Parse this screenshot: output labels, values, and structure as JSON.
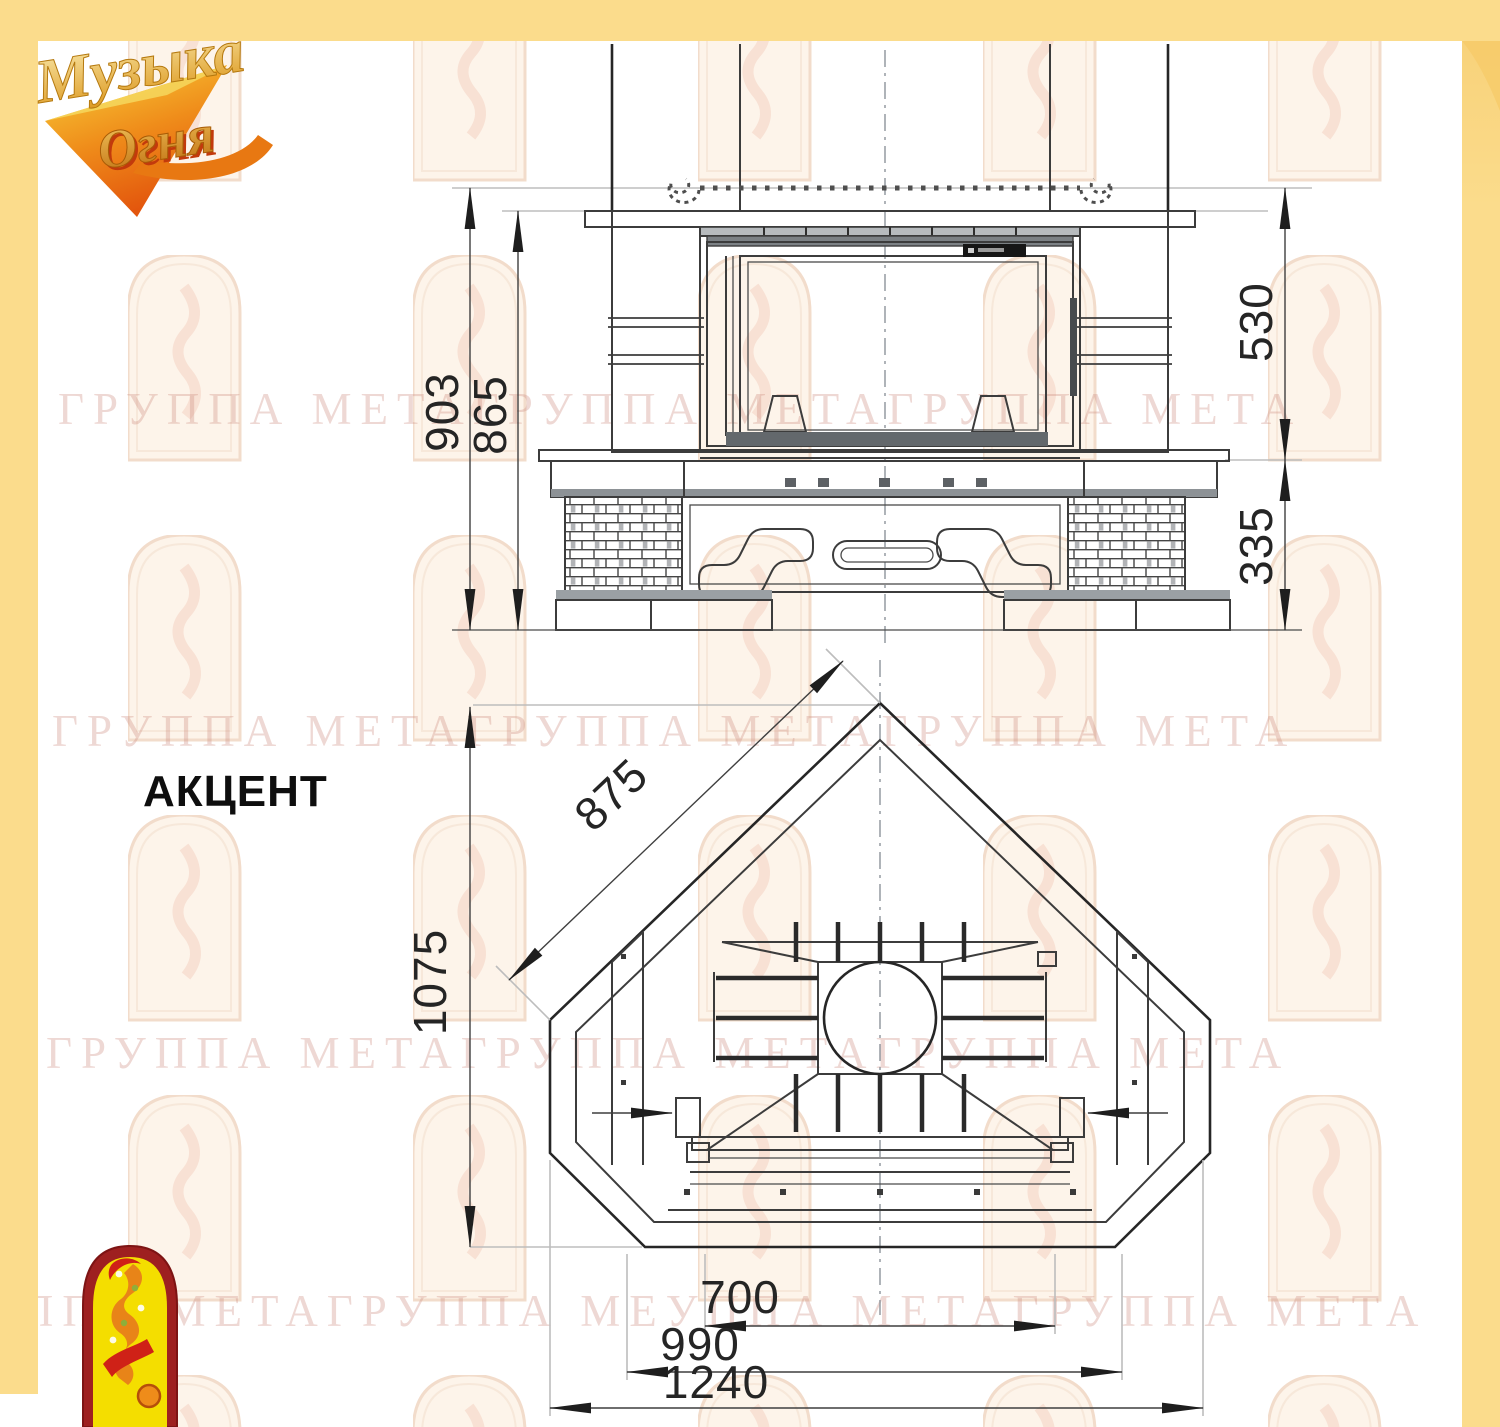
{
  "model": {
    "label": "АКЦЕНТ"
  },
  "logo": {
    "word1": "Музыка",
    "word2": "Огня"
  },
  "watermark": {
    "row1": "ГРУППА МЕТАГРУППА МЕТАГРУППА МЕТА",
    "row2": "ГРУППА МЕТАГРУППА МЕТАГРУППА МЕТА",
    "row3": "ГРУППА МЕТАГРУППА МЕТАГРУППА МЕТА",
    "row4": "ГРУППА МЕТАГРУППА МЕУППА МЕТАГРУППА МЕТА"
  },
  "dimensions": {
    "front": {
      "total_height": "903",
      "height_to_shelf": "865",
      "firebox_height": "530",
      "plinth_height": "335"
    },
    "plan": {
      "facet": "875",
      "depth": "1075",
      "opening": "700",
      "mid_width": "990",
      "total_width": "1240"
    }
  },
  "colors": {
    "frame_yellow": "#fbdc8c",
    "frame_yellow_deep": "#f6cb69",
    "drawing_line": "#3c3c3c",
    "watermark_pink": "#cc8c81",
    "emblem_red": "#9e2020",
    "emblem_yellow": "#f4de00",
    "logo_gold": "#e0a226",
    "logo_flame": "#e4560d"
  }
}
